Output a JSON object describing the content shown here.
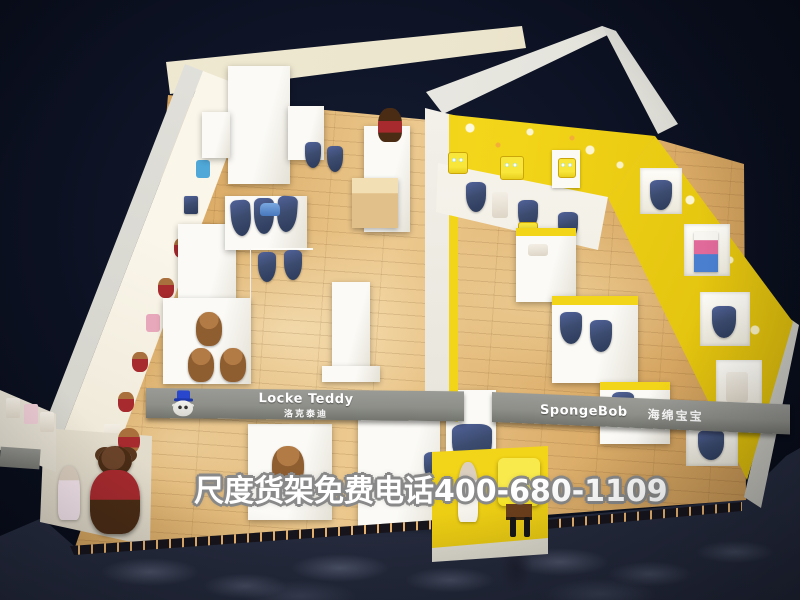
{
  "meta": {
    "title": "Children's clothing store 3D showroom render",
    "view": "isometric bird's-eye",
    "store_type": "kids apparel shop with two brand zones"
  },
  "watermark": {
    "text": "尺度货架免费电话400-680-1109"
  },
  "zones": {
    "left": {
      "brand_en": "Locke Teddy",
      "brand_cn": "洛克泰迪",
      "theme": "white shelving with teddy bear mascots"
    },
    "right": {
      "brand_en": "SpongeBob",
      "brand_cn": "海绵宝宝",
      "theme": "yellow walls with star wallpaper and SpongeBob mascots"
    }
  },
  "colors": {
    "background": "#0a0f1d",
    "outer_floor": "#2c3349",
    "wood": "#d9a963",
    "fascia": "#8e8f89",
    "cream": "#ece5cd",
    "yellow": "#f2d418",
    "white_shelf": "#f4f2ec",
    "denim": "#3c4c70",
    "teddy": "#8f5e30",
    "teddy_dark": "#4a2c15",
    "red_shirt": "#a62a2e",
    "sb_yellow": "#f5e11f",
    "logo_hat_blue": "#2947cc"
  }
}
